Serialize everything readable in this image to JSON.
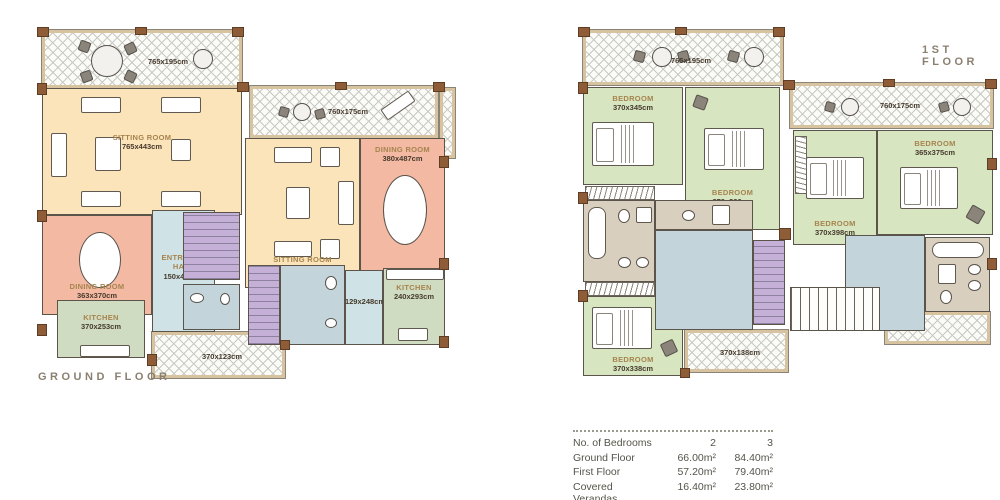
{
  "ground_floor": {
    "title": "GROUND FLOOR",
    "verandas": {
      "top_left": "765x195cm",
      "top_right": "760x175cm",
      "bottom": "370x123cm"
    },
    "rooms": {
      "sitting_left": {
        "name": "SITTING ROOM",
        "dims": "765x443cm"
      },
      "dining_left": {
        "name": "DINING ROOM",
        "dims": "363x370cm"
      },
      "kitchen_left": {
        "name": "KITCHEN",
        "dims": "370x253cm"
      },
      "entrance_hall": {
        "name": "ENTRANCE HALL",
        "dims": "150x473cm"
      },
      "sitting_right": {
        "name": "SITTING ROOM",
        "dims": "383x487cm"
      },
      "dining_right": {
        "name": "DINING ROOM",
        "dims": "380x487cm"
      },
      "kitchen_right": {
        "name": "KITCHEN",
        "dims": "240x293cm"
      },
      "hall_right": {
        "dims": "129x248cm"
      }
    }
  },
  "first_floor": {
    "title": "1ST FLOOR",
    "verandas": {
      "top_left": "765x195cm",
      "top_right": "760x175cm",
      "bottom_left": "370x138cm"
    },
    "rooms": {
      "bedroom_top_left": {
        "name": "BEDROOM",
        "dims": "370x345cm"
      },
      "bedroom_mid": {
        "name": "BEDROOM",
        "dims": "370x390cm"
      },
      "bedroom_bottom_left": {
        "name": "BEDROOM",
        "dims": "370x338cm"
      },
      "bedroom_right_1": {
        "name": "BEDROOM",
        "dims": "370x398cm"
      },
      "bedroom_right_2": {
        "name": "BEDROOM",
        "dims": "365x375cm"
      }
    }
  },
  "spec_table": {
    "rows": [
      {
        "label": "No. of Bedrooms",
        "v1": "2",
        "v2": "3"
      },
      {
        "label": "Ground Floor",
        "v1": "66.00m²",
        "v2": "84.40m²"
      },
      {
        "label": "First Floor",
        "v1": "57.20m²",
        "v2": "79.40m²"
      },
      {
        "label": "Covered Verandas",
        "v1": "16.40m²",
        "v2": "23.80m²"
      }
    ]
  },
  "colors": {
    "sitting": "#fbe4ba",
    "dining": "#f3b9a3",
    "kitchen": "#cfdcc2",
    "hall": "#cfe3e6",
    "bedroom": "#d7e5c1",
    "stairs": "#c5b0d8",
    "bathroom": "#d9cfbf",
    "wall_brown": "#8e5d38",
    "label_gold": "#a6844e",
    "label_dark": "#463a2c"
  }
}
